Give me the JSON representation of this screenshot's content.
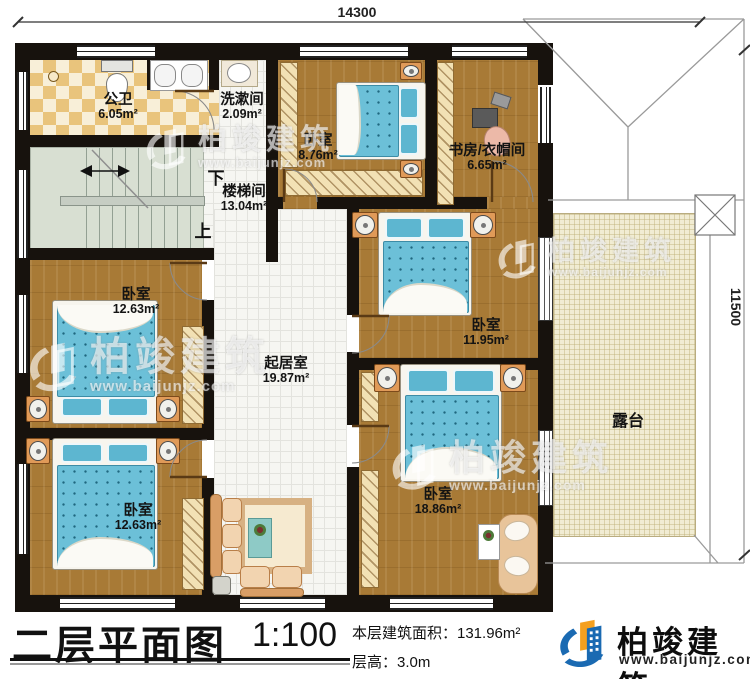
{
  "dimensions": {
    "top": "14300",
    "right": "11500"
  },
  "rooms": [
    {
      "name": "公卫",
      "area": "6.05m²"
    },
    {
      "name": "洗漱间",
      "area": "2.09m²"
    },
    {
      "name": "卧室",
      "area": "8.76m²"
    },
    {
      "name": "书房/衣帽间",
      "area": "6.65m²"
    },
    {
      "name": "楼梯间",
      "area": "13.04m²"
    },
    {
      "name": "卧室",
      "area": "12.63m²"
    },
    {
      "name": "起居室",
      "area": "19.87m²"
    },
    {
      "name": "卧室",
      "area": "11.95m²"
    },
    {
      "name": "卧室",
      "area": "18.86m²"
    },
    {
      "name": "卧室",
      "area": "12.63m²"
    },
    {
      "name": "露台",
      "area": ""
    }
  ],
  "stairs": {
    "up": "上",
    "down": "下"
  },
  "titleblock": {
    "title": "二层平面图",
    "scale": "1:100",
    "area_label": "本层建筑面积：131.96m²",
    "floor_height_label": "层高：3.0m"
  },
  "brand": {
    "name": "柏竣建筑",
    "url": "www.baijunjz.com",
    "blue": "#1a6ab2",
    "orange": "#f5a01f"
  },
  "watermark": {
    "name": "柏竣建筑",
    "url": "www.baijunjz.com"
  }
}
